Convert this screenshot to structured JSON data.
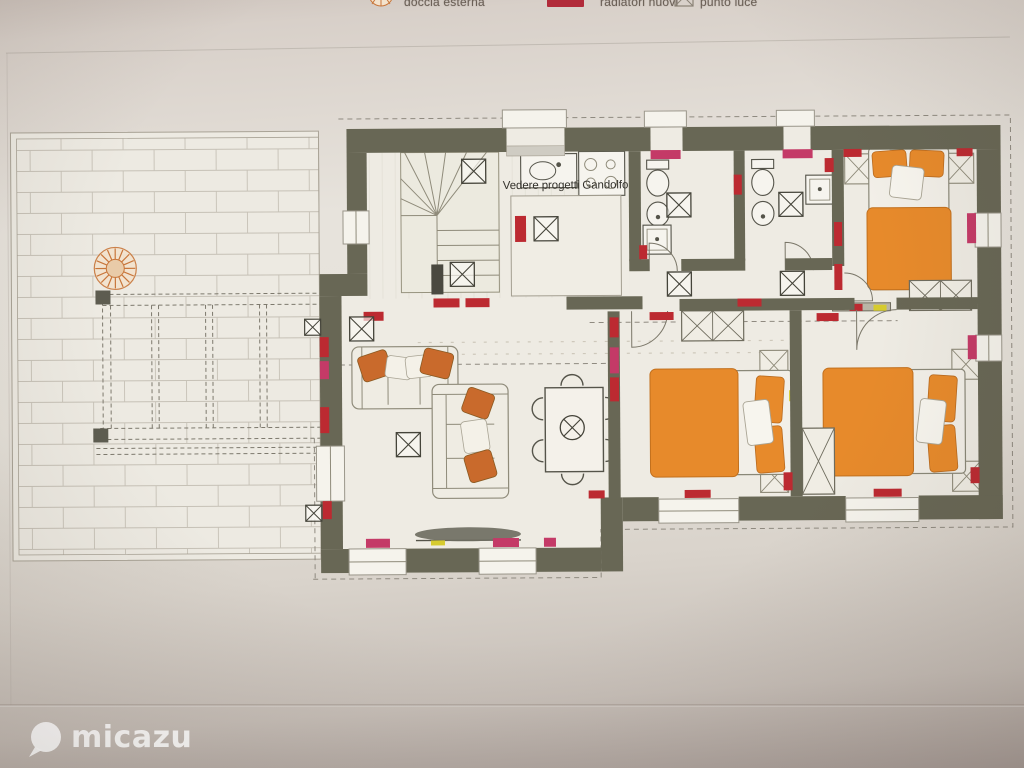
{
  "legend": {
    "items": [
      {
        "icon": "outdoor-shower-sun-icon",
        "label": "doccia esterna"
      },
      {
        "icon": "new-radiator-swatch-icon",
        "label": "radiatori nuovi"
      },
      {
        "icon": "light-point-icon",
        "label": "punto luce"
      }
    ]
  },
  "plan": {
    "note": "Vedere progetti Gandolfo"
  },
  "watermark": {
    "brand": "micazu"
  },
  "colors": {
    "wall": "#686755",
    "radiator_new": "#bc2a31",
    "radiator_alt": "#c43a67",
    "furniture_orange": "#e78a2b",
    "accent_yellow": "#d6cb2f",
    "paper": "#e7e3dc"
  }
}
